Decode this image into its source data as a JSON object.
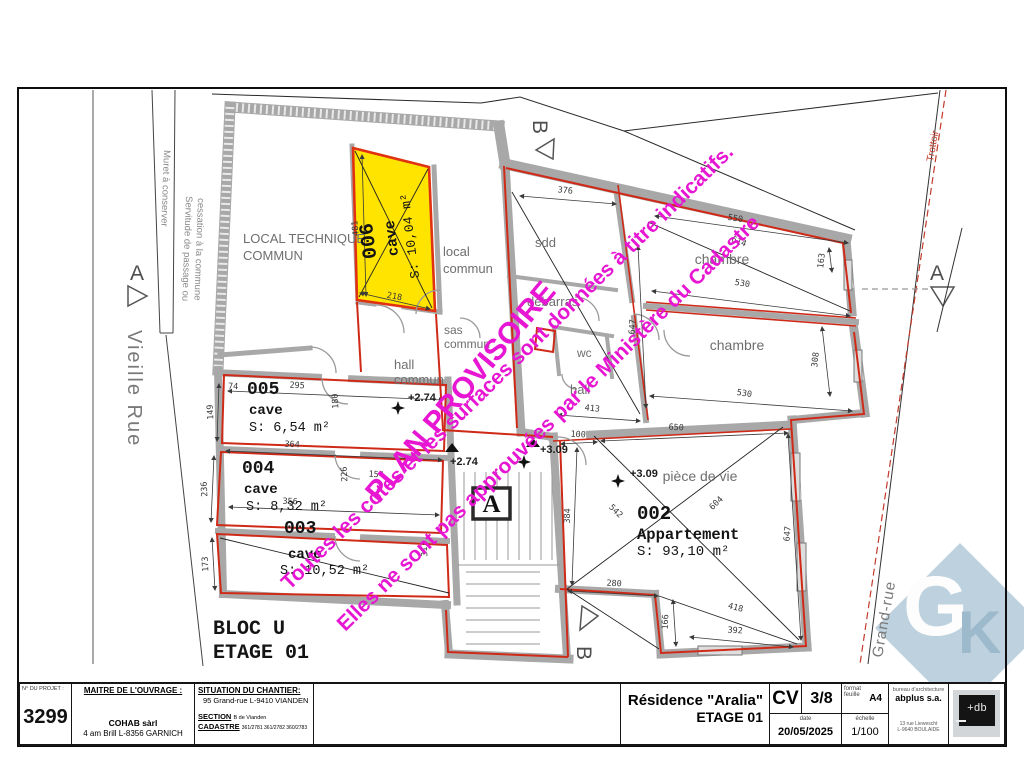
{
  "title_block": {
    "project_label": "N° DU PROJET :",
    "project_number": "3299",
    "owner_label": "MAITRE DE L'OUVRAGE :",
    "owner_name": "COHAB sàrl",
    "owner_address": "4 am Brill  L-8356 GARNICH",
    "site_label": "SITUATION DU CHANTIER:",
    "site_address": "95 Grand-rue L-9410 VIANDEN",
    "section_label": "SECTION",
    "section_value": "B de Vianden",
    "cadastre_label": "CADASTRE",
    "cadastre_value": "361/2781 361/2782 360/2783",
    "drawing_title": "Résidence \"Aralia\"",
    "drawing_subtitle": "ETAGE 01",
    "sheet_type": "CV",
    "sheet_number": "3/8",
    "format_label1": "format",
    "format_label2": "feuille",
    "format_value": "A4",
    "date_label": "date",
    "date_value": "20/05/2025",
    "scale_label": "échelle",
    "scale_value": "1/100",
    "firm_label": "bureau d'architecture",
    "firm_name": "abplus s.a.",
    "firm_address1": "13 rue Liewescht",
    "firm_address2": "L-9640 BOULAIDE",
    "logo_text": "+db"
  },
  "plan": {
    "bloc_label": "BLOC U",
    "etage_label": "ETAGE 01",
    "streets": {
      "left": "Vieille Rue",
      "right": "Grand-rue",
      "sidewalk": "Trottoir"
    },
    "annotations": {
      "muret": "Muret à conserver",
      "servitude1": "Servitude de passage ou",
      "servitude2": "cessation à la commune"
    },
    "watermark": {
      "provisional": "PLAN PROVISOIRE",
      "line1": "Toutes les cotes et les surfaces sont données à titre indicatifs.",
      "line2": "Elles ne sont pas approuvées par le Ministère du Cadastre",
      "color": "#e716d3"
    },
    "section_markers": {
      "a": "A",
      "b": "B"
    },
    "stair_core": "A",
    "levels": {
      "v274": "+2.74",
      "v309": "+3.09"
    },
    "rooms": {
      "local_technique": {
        "l1": "LOCAL TECHNIQUE",
        "l2": "COMMUN"
      },
      "cave006": {
        "number": "006",
        "type": "cave",
        "area": "S: 10,04 m²",
        "highlight": "#ffe400"
      },
      "local_commun": {
        "l1": "local",
        "l2": "commun"
      },
      "sas_commun": {
        "l1": "sas",
        "l2": "commun"
      },
      "hall_commun": {
        "l1": "hall",
        "l2": "commun"
      },
      "cave005": {
        "number": "005",
        "type": "cave",
        "area": "S: 6,54 m²"
      },
      "cave004": {
        "number": "004",
        "type": "cave",
        "area": "S: 8,32 m²"
      },
      "cave003": {
        "number": "003",
        "type": "cave",
        "area": "S: 10,52 m²"
      },
      "sdd": "sdd",
      "debarras": "débarras",
      "wc": "wc",
      "hall": "hall",
      "chambre1": "chambre",
      "chambre2": "chambre",
      "piece_de_vie": "pièce de vie",
      "apt002": {
        "number": "002",
        "type": "Appartement",
        "area": "S: 93,10 m²"
      }
    },
    "dims": [
      "481",
      "218",
      "74",
      "295",
      "149",
      "180",
      "364",
      "236",
      "356",
      "226",
      "173",
      "313",
      "376",
      "647",
      "550",
      "614",
      "530",
      "163",
      "530",
      "308",
      "413",
      "100",
      "650",
      "384",
      "542",
      "604",
      "647",
      "280",
      "166",
      "418",
      "392",
      "154"
    ]
  },
  "corner_logo": {
    "letters_g": "G",
    "letters_k": "K"
  }
}
